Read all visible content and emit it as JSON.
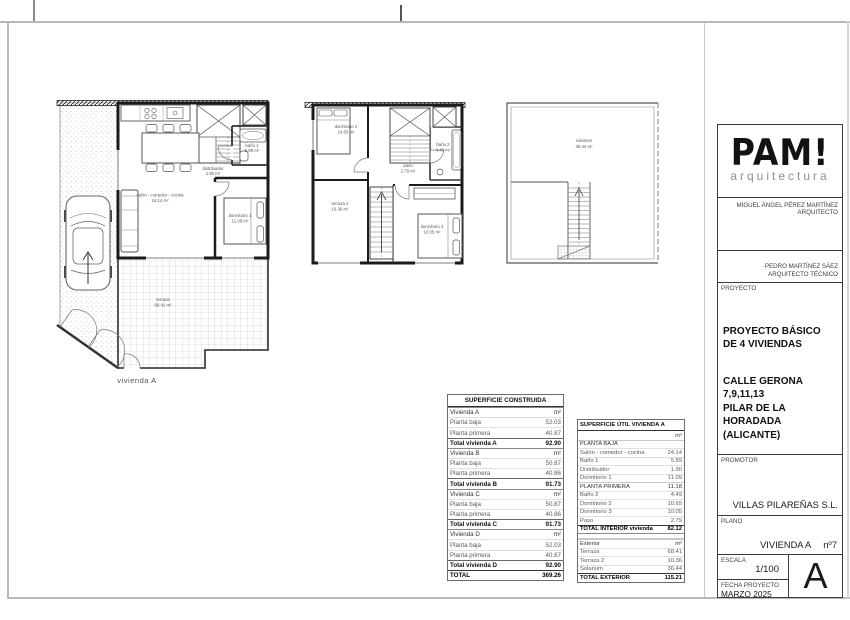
{
  "plans": {
    "caption": "vivienda A",
    "pb": {
      "salon": {
        "n": "salón - comedor - cocina",
        "a": "24.14 m²"
      },
      "distribuidor": {
        "n": "distribuidor",
        "a": "1.90 m²"
      },
      "bano1": {
        "n": "baño 1",
        "a": "5.89 m²"
      },
      "dorm1": {
        "n": "dormitorio 1",
        "a": "11.09 m²"
      },
      "terraza": {
        "n": "terraza",
        "a": "68.41 m²"
      }
    },
    "pp": {
      "dorm2": {
        "n": "dormitorio 2",
        "a": "10.65 m²"
      },
      "bano2": {
        "n": "baño 2",
        "a": "4.49 m²"
      },
      "paso": {
        "n": "paso",
        "a": "2.79 m²"
      },
      "terraza2": {
        "n": "terraza 2",
        "a": "10.36 m²"
      },
      "dorm3": {
        "n": "dormitorio 3",
        "a": "10.05 m²"
      }
    },
    "sol": {
      "solarium": {
        "n": "solarium",
        "a": "36.44 m²"
      }
    }
  },
  "tables": {
    "construida": {
      "title": "SUPERFICIE CONSTRUIDA",
      "rows": [
        {
          "label": "Vivienda A",
          "value": "m²",
          "type": "section"
        },
        {
          "label": "Planta baja",
          "value": "52.03",
          "type": "item"
        },
        {
          "label": "Planta primera",
          "value": "40.87",
          "type": "item"
        },
        {
          "label": "Total vivienda A",
          "value": "92.90",
          "type": "total"
        },
        {
          "label": "Vivienda B",
          "value": "m²",
          "type": "section"
        },
        {
          "label": "Planta baja",
          "value": "50.87",
          "type": "item"
        },
        {
          "label": "Planta primera",
          "value": "40.86",
          "type": "item"
        },
        {
          "label": "Total vivienda B",
          "value": "91.73",
          "type": "total"
        },
        {
          "label": "Vivienda C",
          "value": "m²",
          "type": "section"
        },
        {
          "label": "Planta baja",
          "value": "50.87",
          "type": "item"
        },
        {
          "label": "Planta primera",
          "value": "40.86",
          "type": "item"
        },
        {
          "label": "Total vivienda C",
          "value": "91.73",
          "type": "total"
        },
        {
          "label": "Vivienda D",
          "value": "m²",
          "type": "section"
        },
        {
          "label": "Planta baja",
          "value": "52.03",
          "type": "item"
        },
        {
          "label": "Planta primera",
          "value": "40.87",
          "type": "item"
        },
        {
          "label": "Total vivienda D",
          "value": "92.90",
          "type": "total"
        },
        {
          "label": "TOTAL",
          "value": "369.26",
          "type": "grand"
        }
      ]
    },
    "util": {
      "title": "SUPERFICIE ÚTIL VIVIENDA A",
      "rows": [
        {
          "label": "",
          "value": "m²",
          "type": "unit"
        },
        {
          "label": "PLANTA BAJA",
          "value": "",
          "type": "section"
        },
        {
          "label": "Salón - comedor - cocina",
          "value": "24.14",
          "type": "item"
        },
        {
          "label": "Baño 1",
          "value": "5.89",
          "type": "item"
        },
        {
          "label": "Distribuidor",
          "value": "1.90",
          "type": "item"
        },
        {
          "label": "Dormitorio 1",
          "value": "11.09",
          "type": "item"
        },
        {
          "label": "PLANTA PRIMERA",
          "value": "11.18",
          "type": "section"
        },
        {
          "label": "Baño 2",
          "value": "4.49",
          "type": "item"
        },
        {
          "label": "Dormitorio 2",
          "value": "10.65",
          "type": "item"
        },
        {
          "label": "Dormitorio 3",
          "value": "10.05",
          "type": "item"
        },
        {
          "label": "Paso",
          "value": "2.79",
          "type": "item"
        },
        {
          "label": "TOTAL INTERIOR vivienda",
          "value": "82.12",
          "type": "grand"
        },
        {
          "label": "",
          "value": "",
          "type": "gap"
        },
        {
          "label": "Exterior",
          "value": "m²",
          "type": "section"
        },
        {
          "label": "Terraza",
          "value": "68.41",
          "type": "item"
        },
        {
          "label": "Terraza 2",
          "value": "10.36",
          "type": "item"
        },
        {
          "label": "Solarium",
          "value": "36.44",
          "type": "item"
        },
        {
          "label": "TOTAL EXTERIOR",
          "value": "115.21",
          "type": "grand"
        }
      ]
    }
  },
  "titleblock": {
    "logo": "PAM!",
    "logo_sub": "arquitectura",
    "architect_name": "MIGUEL ÁNGEL PÉREZ MARTÍNEZ",
    "architect_role": "ARQUITECTO",
    "technical_name": "PEDRO MARTÍNEZ SÁEZ",
    "technical_role": "ARQUITECTO TÉCNICO",
    "proyecto_label": "PROYECTO",
    "proyecto_title": "PROYECTO BÁSICO DE 4 VIVIENDAS",
    "proyecto_address": [
      "CALLE GERONA",
      "7,9,11,13",
      "PILAR DE LA HORADADA",
      "(ALICANTE)"
    ],
    "promotor_label": "PROMOTOR",
    "promotor": "VILLAS PILAREÑAS S.L.",
    "plano_label": "PLANO",
    "plano": "VIVIENDA A",
    "plano_num": "nº7",
    "escala_label": "ESCALA",
    "escala": "1/100",
    "fecha_label": "FECHA PROYECTO",
    "fecha": "MARZO 2025",
    "sheet_letter": "A"
  },
  "colors": {
    "wall_ink": "#1b1b1b",
    "border_gray": "#b9b9b9",
    "label_gray": "#555555"
  }
}
